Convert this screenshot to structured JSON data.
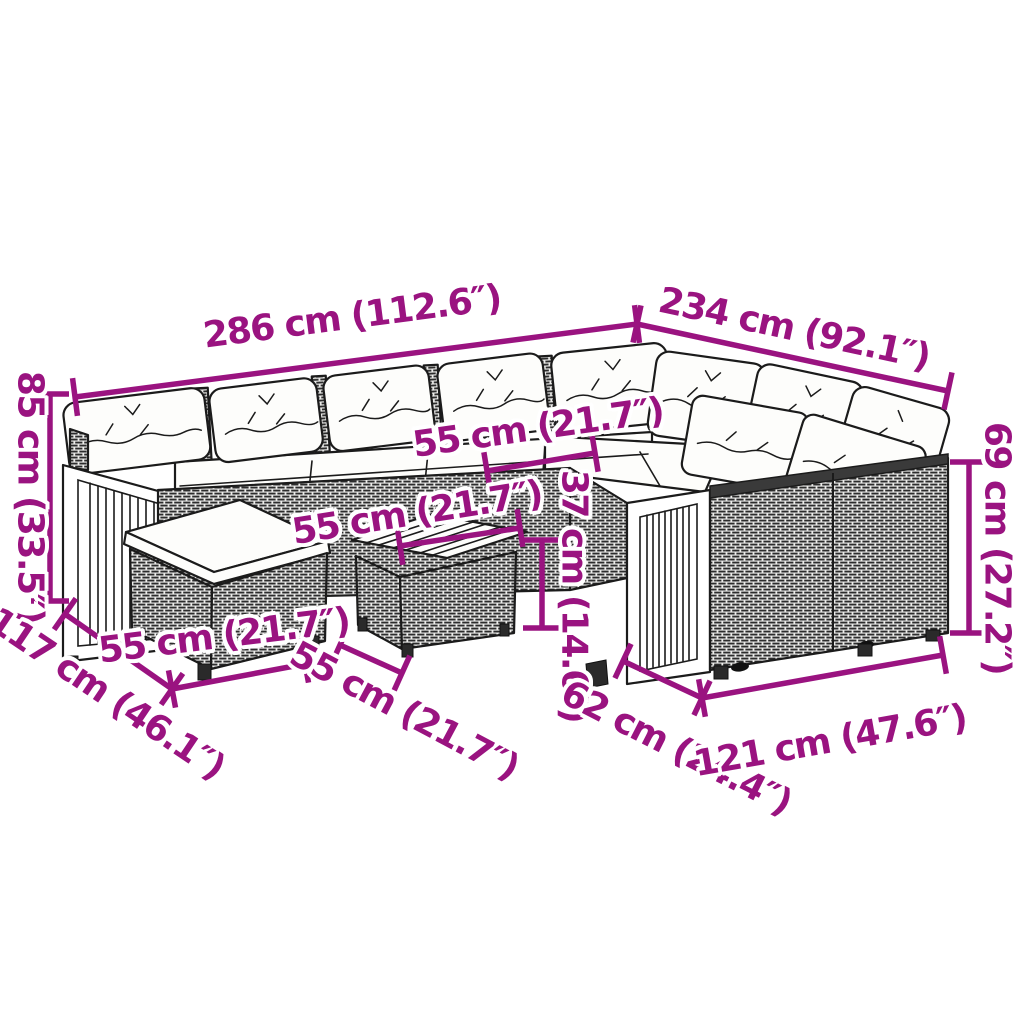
{
  "canvas": {
    "width": 1024,
    "height": 1024,
    "background": "#ffffff"
  },
  "colors": {
    "dimension_accent": "#9a1380",
    "line_art": "#1b1b1b",
    "rattan_fill": "#ededeb",
    "cushion_fill": "#fdfdfb"
  },
  "figure": {
    "type": "product-dimension-diagram",
    "subject": "poly rattan corner lounge set with wood-slat arm panels, ottoman and coffee table"
  },
  "dimensions": [
    {
      "name": "286",
      "text": "286 cm (112.6″)",
      "cx": 352,
      "cy": 317,
      "rot": -7.4,
      "line": [
        75,
        397,
        637,
        324
      ]
    },
    {
      "name": "234",
      "text": "234 cm (92.1″)",
      "cx": 794,
      "cy": 329,
      "rot": 12.2,
      "line": [
        637,
        324,
        948,
        391
      ]
    },
    {
      "name": "85",
      "text": "85 cm (33.5″)",
      "cx": 30,
      "cy": 497,
      "rot": 90,
      "line": [
        50,
        394,
        50,
        601
      ]
    },
    {
      "name": "55-seat",
      "text": "55 cm (21.7″)",
      "cx": 538,
      "cy": 428,
      "rot": -8,
      "line": [
        487,
        471,
        595,
        453
      ]
    },
    {
      "name": "69",
      "text": "69 cm (27.2″)",
      "cx": 997,
      "cy": 548,
      "rot": 90,
      "line": [
        969,
        462,
        969,
        633
      ]
    },
    {
      "name": "55-table",
      "text": "55 cm (21.7″)",
      "cx": 417,
      "cy": 513,
      "rot": -9,
      "line": [
        400,
        546,
        520,
        528
      ]
    },
    {
      "name": "37",
      "text": "37 cm (14.6″)",
      "cx": 574,
      "cy": 596,
      "rot": 90,
      "line": [
        542,
        540,
        542,
        628
      ]
    },
    {
      "name": "55-ottoman",
      "text": "55 cm (21.7″)",
      "cx": 224,
      "cy": 636,
      "rot": -7,
      "line": [
        172,
        689,
        305,
        664
      ]
    },
    {
      "name": "117",
      "text": "117 cm (46.1″)",
      "cx": 106,
      "cy": 694,
      "rot": 34,
      "line": [
        65,
        614,
        172,
        689
      ]
    },
    {
      "name": "55-bottom",
      "text": "55 cm (21.7″)",
      "cx": 404,
      "cy": 711,
      "rot": 28,
      "line": [
        340,
        645,
        402,
        673
      ]
    },
    {
      "name": "62",
      "text": "62 cm (24.4″)",
      "cx": 676,
      "cy": 748,
      "rot": 27,
      "line": [
        623,
        661,
        702,
        698
      ]
    },
    {
      "name": "121",
      "text": "121 cm (47.6″)",
      "cx": 830,
      "cy": 741,
      "rot": -10,
      "line": [
        702,
        698,
        943,
        655
      ]
    }
  ]
}
